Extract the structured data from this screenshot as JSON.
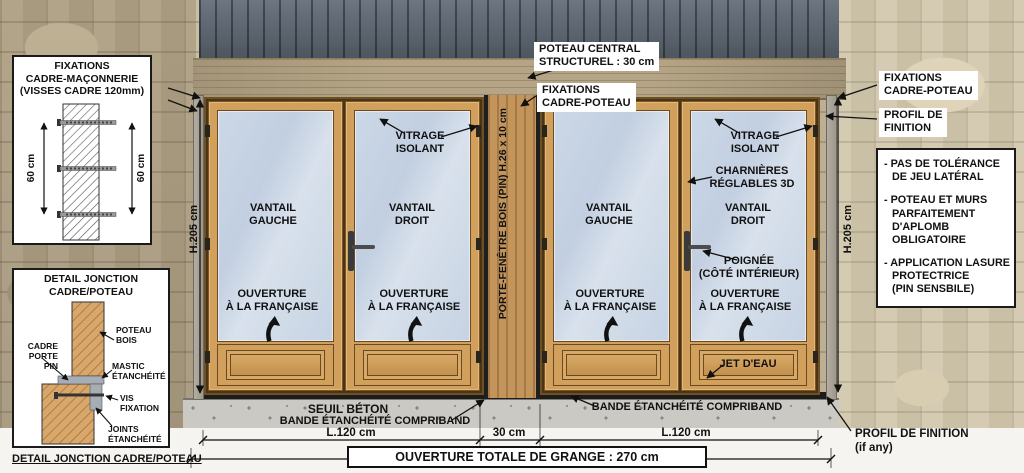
{
  "colors": {
    "label_text": "#111111",
    "label_bg": "#ffffff",
    "wood_frame": "#d0a05c",
    "wood_post": "#c3955a",
    "glass": "#c7d4e4",
    "cladding": "#5c6672",
    "lintel": "#b5a586",
    "stone": "#c6b99c",
    "concrete": "#cac9c4",
    "compriband": "#1c1c1c"
  },
  "detail_fixations": {
    "title": "FIXATIONS\nCADRE-MAÇONNERIE\n(VISSES CADRE 120mm)",
    "dim_left": "60 cm",
    "dim_right": "60 cm"
  },
  "detail_jonction": {
    "title": "DETAIL JONCTION\nCADRE/POTEAU",
    "cadre": "CADRE\nPORTE\nPIN",
    "poteau": "POTEAU\nBOIS",
    "mastic": "MASTIC\nÉTANCHÉITÉ",
    "vis": "VIS\nFIXATION",
    "joints": "JOINTS\nÉTANCHÉITÉ",
    "caption": "DETAIL JONCTION CADRE/POTEAU"
  },
  "header": {
    "poteau_central": "POTEAU CENTRAL\nSTRUCTUREL : 30 cm",
    "fixations_cadre_poteau_center": "FIXATIONS\nCADRE-POTEAU",
    "fixations_cadre_poteau_right": "FIXATIONS\nCADRE-POTEAU",
    "profil_de_finition_right": "PROFIL DE\nFINITION"
  },
  "notes": [
    "- PAS DE TOLÉRANCE\nDE JEU LATÉRAL",
    "- POTEAU ET MURS\nPARFAITEMENT\nD'APLOMB\nOBLIGATOIRE",
    "- APPLICATION LASURE\nPROTECTRICE\n(PIN SENSBILE)"
  ],
  "doors": {
    "vitrage_isolant_left": "VITRAGE\nISOLANT",
    "vitrage_isolant_right": "VITRAGE\nISOLANT",
    "charnieres": "CHARNIÈRES\nRÉGLABLES 3D",
    "poignee": "POIGNÉE\n(CÔTÉ INTÉRIEUR)",
    "jet_eau": "JET D'EAU",
    "leaves": [
      {
        "name": "VANTAIL\nGAUCHE",
        "opening": "OUVERTURE\nÀ LA FRANÇAISE"
      },
      {
        "name": "VANTAIL\nDROIT",
        "opening": "OUVERTURE\nÀ LA FRANÇAISE"
      },
      {
        "name": "VANTAIL\nGAUCHE",
        "opening": "OUVERTURE\nÀ LA FRANÇAISE"
      },
      {
        "name": "VANTAIL\nDROIT",
        "opening": "OUVERTURE\nÀ LA FRANÇAISE"
      }
    ]
  },
  "central_post_label": "PORTE-FENÊTRE BOIS (PIN) H.26 x 10 cm",
  "dimensions": {
    "height_left": "H.205 cm",
    "height_right": "H.205 cm",
    "width_left": "L.120 cm",
    "width_center": "30 cm",
    "width_right": "L.120 cm",
    "total": "OUVERTURE TOTALE DE GRANGE : 270 cm"
  },
  "base": {
    "seuil": "SEUIL BÉTON",
    "bande_left": "BANDE ÉTANCHÉITÉ COMPRIBAND",
    "bande_right": "BANDE ÉTANCHÉITÉ COMPRIBAND",
    "profil_if_any": "PROFIL DE FINITION\n(if any)"
  }
}
